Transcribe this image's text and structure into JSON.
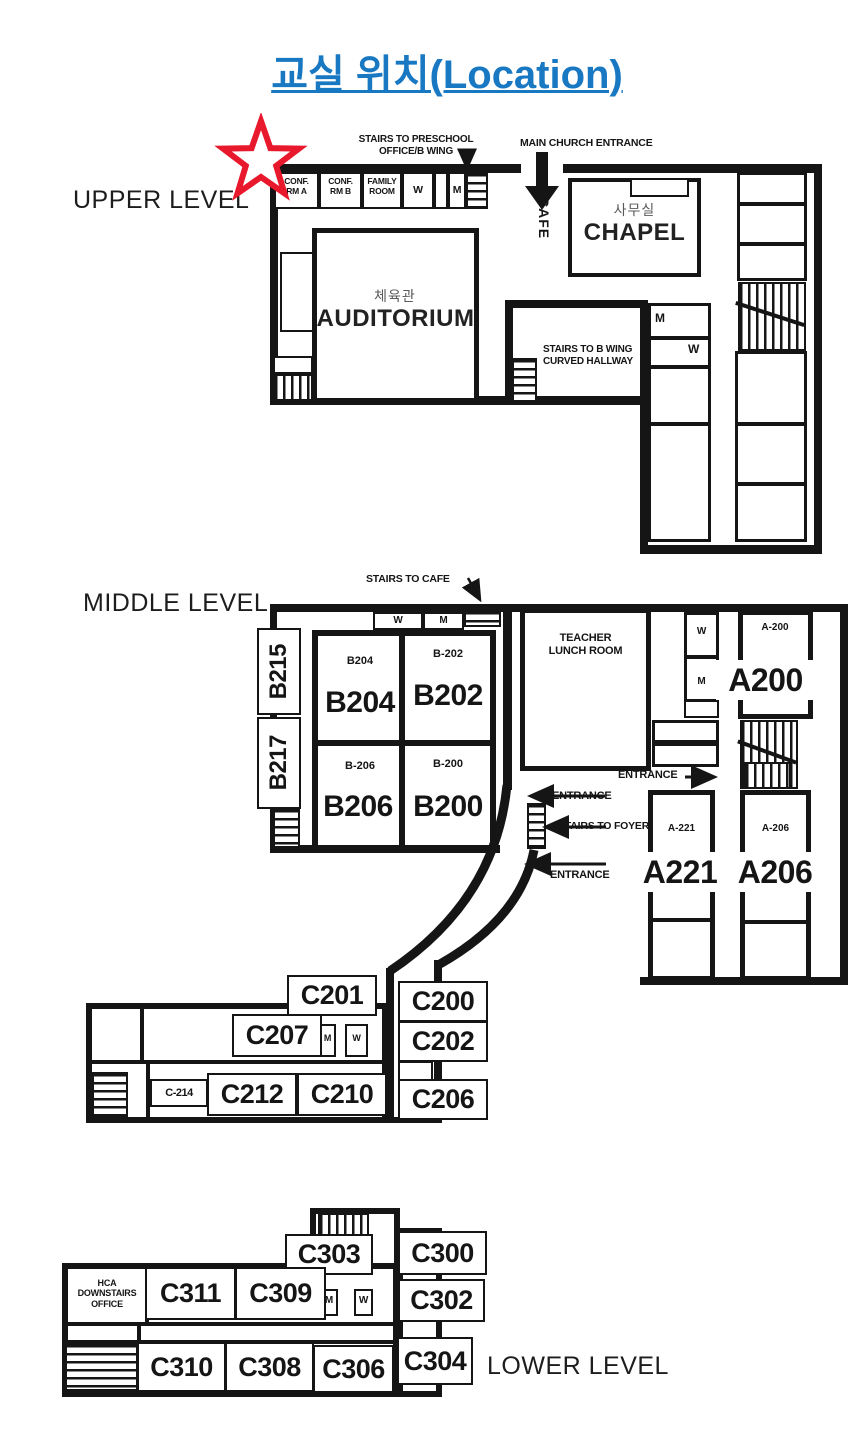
{
  "title": "교실 위치(Location)",
  "colors": {
    "title_blue": "#1878C2",
    "wall_black": "#151515",
    "star_red": "#E8192C"
  },
  "levels": {
    "upper": "UPPER LEVEL",
    "middle": "MIDDLE LEVEL",
    "lower": "LOWER LEVEL"
  },
  "icons": {
    "star": "star-marker",
    "arrows": "direction-arrows"
  },
  "u": {
    "stairs_preschool": "STAIRS TO PRESCHOOL\nOFFICE/B WING",
    "main_entrance": "MAIN CHURCH ENTRANCE",
    "cafe": "CAFE",
    "conf_a": "CONF.\nRM A",
    "conf_b": "CONF.\nRM B",
    "family": "FAMILY\nROOM",
    "w1": "W",
    "m1": "M",
    "auditorium_kr": "체육관",
    "auditorium_en": "AUDITORIUM",
    "chapel_kr": "사무실",
    "chapel_en": "CHAPEL",
    "stairs_bwing": "STAIRS TO B WING\nCURVED HALLWAY",
    "m2": "M",
    "w2": "W"
  },
  "m": {
    "stairs_cafe": "STAIRS TO CAFE",
    "w_top": "W",
    "m_top": "M",
    "b215": "B215",
    "b217": "B217",
    "b204_id": "B204",
    "b204": "B204",
    "b202_id": "B-202",
    "b202": "B202",
    "b206_id": "B-206",
    "b206": "B206",
    "b200_id": "B-200",
    "b200": "B200",
    "teacher_lunch": "TEACHER\nLUNCH ROOM",
    "w_right": "W",
    "m_right": "M",
    "entrance_right": "ENTRANCE",
    "a200_id": "A-200",
    "a200": "A200",
    "a221_id": "A-221",
    "a221": "A221",
    "a206_id": "A-206",
    "a206": "A206",
    "entrance1": "ENTRANCE",
    "stairs_foyer": "STAIRS TO FOYER",
    "entrance2": "ENTRANCE",
    "c201": "C201",
    "c200": "C200",
    "c207": "C207",
    "c202": "C202",
    "c214_id": "C-214",
    "c212": "C212",
    "c210": "C210",
    "c206": "C206",
    "mw_m": "M",
    "mw_w": "W"
  },
  "l": {
    "c303": "C303",
    "c300": "C300",
    "hca": "HCA\nDOWNSTAIRS\nOFFICE",
    "c311": "C311",
    "c309": "C309",
    "m": "M",
    "w": "W",
    "c302": "C302",
    "c310": "C310",
    "c308": "C308",
    "c306": "C306",
    "c304": "C304"
  }
}
